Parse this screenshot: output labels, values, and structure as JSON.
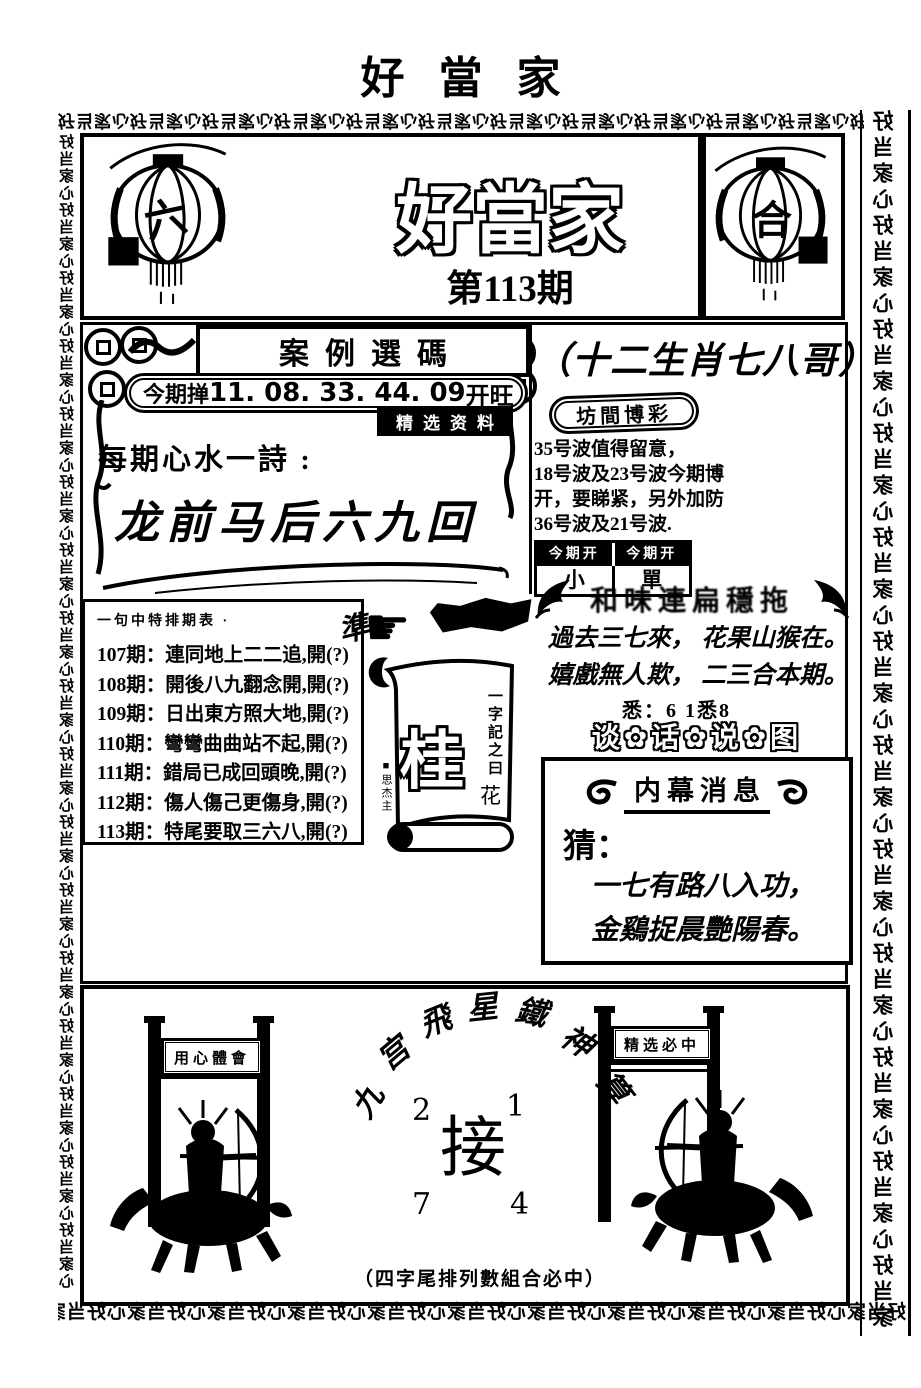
{
  "page": {
    "top_title": "好當家",
    "border_unit": "好当家心"
  },
  "masthead": {
    "title": "好當家",
    "issue": "第113期",
    "lantern_left_char": "六",
    "lantern_right_char": "合"
  },
  "left_panel": {
    "section_header": "案例選碼",
    "pick_label": "今期掸",
    "pick_numbers": "11. 08. 33. 44. 09",
    "pick_suffix": "开旺",
    "badge": "精选资料",
    "poem_label": "每期心水一詩 :",
    "poem": "龙前马后六九回",
    "history": {
      "title": "一句中特排期表 ·",
      "items": [
        "107期：連同地上二二追,開(?)",
        "108期：開後八九翻念開,開(?)",
        "109期：日出東方照大地,開(?)",
        "110期：彎彎曲曲站不起,開(?)",
        "111期：錯局已成回頭晚,開(?)",
        "112期：傷人傷己更傷身,開(?)",
        "113期：特尾要取三六八,開(?)"
      ]
    },
    "accurate_char": "準",
    "pointing_hand": "☛",
    "scroll": {
      "big_char": "桂",
      "side_text": "一字記之曰",
      "side_char": "花",
      "signature": "■思杰主"
    }
  },
  "right_panel": {
    "title": "（十二生肖七八哥）",
    "oval_badge": "坊間博彩",
    "tips": [
      "35号波值得留意，",
      "18号波及23号波今期博",
      "开，要睇紧，另外加防",
      "36号波及21号波."
    ],
    "table": {
      "header_1": "今期开",
      "header_2": "今期开",
      "value_1": "小",
      "value_2": "單"
    },
    "wing_banner": "和味連扁穩拖",
    "poem_lines": [
      "過去三七來， 花果山猴在。",
      "嬉戲無人欺， 二三合本期。"
    ],
    "poem_note": "悉：6 1悉8",
    "flower_banner": "谈✿话✿说✿图",
    "insider": {
      "title": "内幕消息",
      "guess_label": "猜：",
      "lines": [
        "一七有路八入功，",
        "金鷄捉晨艷陽春。"
      ]
    }
  },
  "bottom_panel": {
    "arc_chars": [
      "九",
      "宫",
      "飛",
      "星",
      "鐵",
      "神",
      "算"
    ],
    "numbers": [
      "2",
      "1",
      "7",
      "4"
    ],
    "center_char": "接",
    "caption": "（四字尾排列數組合必中）",
    "left_plaque": "用心體會",
    "right_plaque": "精选必中"
  }
}
